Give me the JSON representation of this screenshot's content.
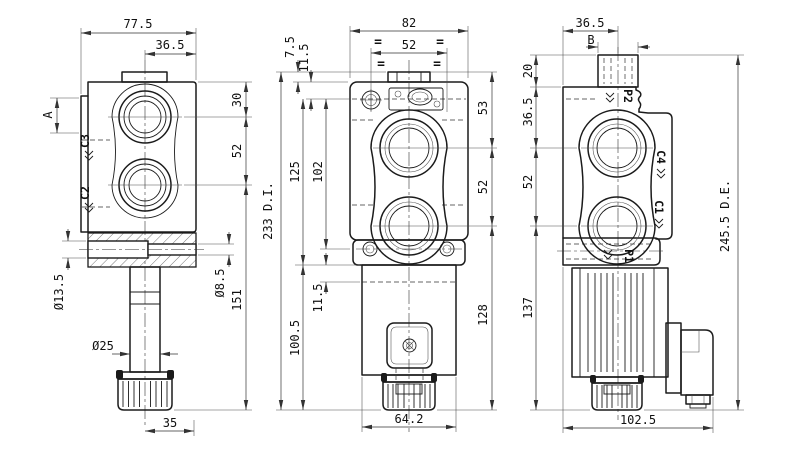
{
  "views": {
    "left": {
      "dims": {
        "overall_width": "77.5",
        "half_width": "36.5",
        "ref_a": "A",
        "top_to_port": "30",
        "port_spacing": "52",
        "hole_dia_small": "Ø8.5",
        "stem_length": "151",
        "hole_dia_side": "Ø13.5",
        "stem_dia": "Ø25",
        "knob_width": "35"
      },
      "ports": {
        "upper": "C3",
        "lower": "C2"
      }
    },
    "front": {
      "dims": {
        "overall_width": "82",
        "port_face_width": "52",
        "boss_height": "7.5",
        "top_offset": "11.5",
        "body_height": "125",
        "bolt_spacing": "102",
        "overall_height": "233 D.I.",
        "lower_height": "100.5",
        "base_offset": "11.5",
        "right_top": "53",
        "right_port_spacing": "52",
        "right_lower": "128",
        "coil_width": "64.2"
      },
      "equal_mark": "="
    },
    "right": {
      "dims": {
        "top_width": "36.5",
        "ref_b": "B",
        "boss_height": "20",
        "top_to_port": "36.5",
        "port_spacing": "52",
        "lower_height": "137",
        "overall_height": "245.5 D.E.",
        "overall_width": "102.5"
      },
      "ports": {
        "top": "P2",
        "side_upper": "C4",
        "side_lower": "C1",
        "bottom": "P1"
      }
    }
  }
}
